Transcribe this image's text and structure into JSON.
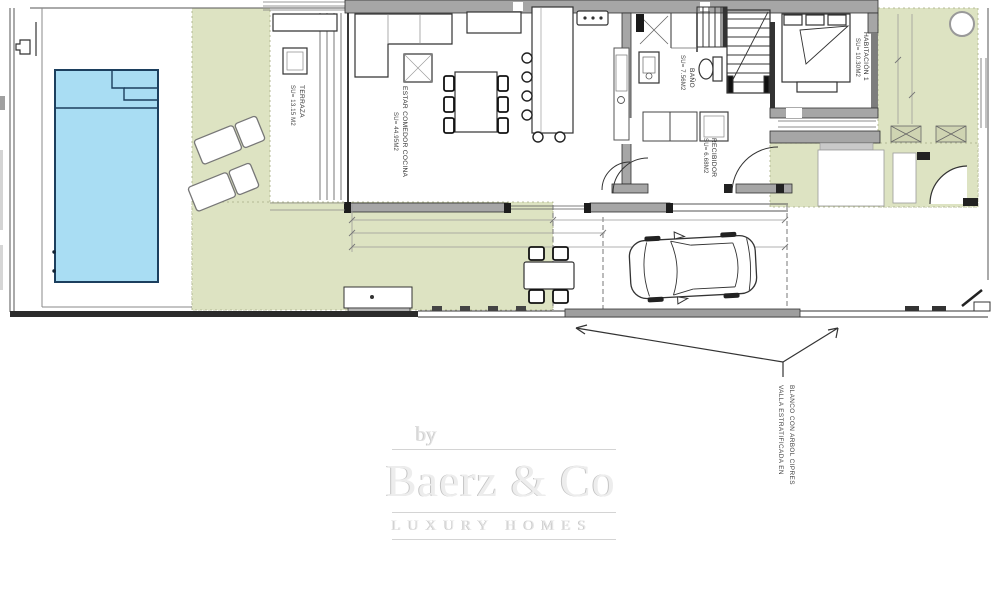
{
  "plan": {
    "rooms": [
      {
        "id": "terraza",
        "name": "TERRAZA",
        "area": "SU= 13.15 M2"
      },
      {
        "id": "estar",
        "name": "ESTAR COMEDOR COCINA",
        "area": "SU= 44.95M2"
      },
      {
        "id": "bano",
        "name": "BAÑO",
        "area": "SU= 7.56M2"
      },
      {
        "id": "recibidor",
        "name": "RECIBIDOR",
        "area": "SU= 6.68M2"
      },
      {
        "id": "habitacion1",
        "name": "HABITACIÓN 1",
        "area": "SU= 10.30M2"
      }
    ],
    "annotation": {
      "line1": "VALLA ESTRATIFICADA EN",
      "line2": "BLANCO CON ARBOL CIPRES"
    },
    "colors": {
      "pool": "#a9ddf3",
      "lawn": "#dde3c2",
      "wall": "#a6a6a6"
    }
  },
  "watermark": {
    "by": "by",
    "brand": "Baerz & Co",
    "tagline": "LUXURY HOMES"
  }
}
